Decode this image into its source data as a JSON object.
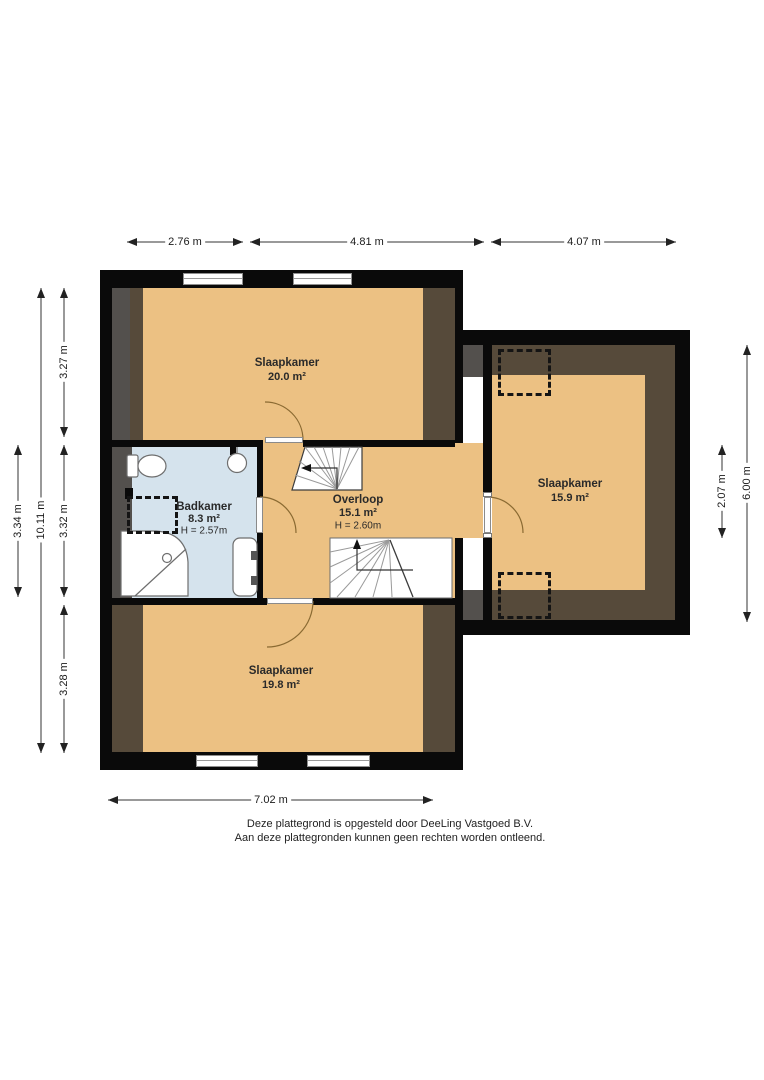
{
  "rooms": {
    "top": {
      "name": "Slaapkamer",
      "area": "20.0 m²"
    },
    "bath": {
      "name": "Badkamer",
      "area": "8.3 m²",
      "height": "H = 2.57m"
    },
    "landing": {
      "name": "Overloop",
      "area": "15.1 m²",
      "height": "H = 2.60m"
    },
    "right": {
      "name": "Slaapkamer",
      "area": "15.9 m²"
    },
    "bottom": {
      "name": "Slaapkamer",
      "area": "19.8 m²"
    }
  },
  "dimensions": {
    "top_1": "2.76 m",
    "top_2": "4.81 m",
    "top_3": "4.07 m",
    "bottom_1": "7.02 m",
    "left_outer": "3.34 m",
    "left_total": "10.11 m",
    "left_top": "3.27 m",
    "left_mid": "3.32 m",
    "left_bottom": "3.28 m",
    "right_inner": "2.07 m",
    "right_outer": "6.00 m"
  },
  "footer": {
    "line1": "Deze plattegrond is opgesteld door DeeLing Vastgoed B.V.",
    "line2": "Aan deze plattegronden kunnen geen rechten worden ontleend."
  },
  "colors": {
    "wall": "#0a0a0a",
    "floor": "#ecc183",
    "bath_floor": "#d5e3ed",
    "sloped_dark": "#564a3a",
    "sloped_gray": "#53504d"
  }
}
